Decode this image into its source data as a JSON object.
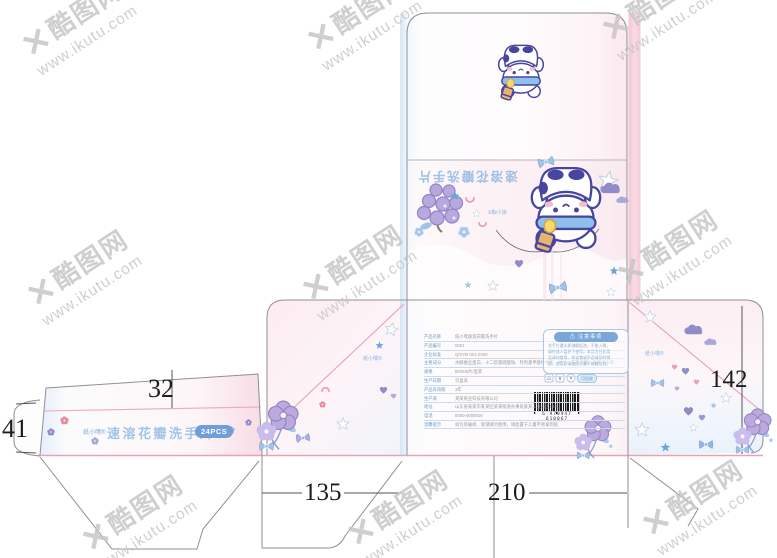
{
  "watermark": {
    "logo": "✕",
    "brand": "酷图网",
    "url": "www.ikutu.com"
  },
  "dimensions": {
    "top": "32",
    "left_tab": "41",
    "bottom_left": "135",
    "bottom_center": "210",
    "right": "142"
  },
  "brand": {
    "name": "纸小嘿®"
  },
  "side_strip": {
    "title": "速溶花瓣洗手片",
    "badge": "24PCS"
  },
  "back_panel": {
    "title": "速溶花瓣洗手片",
    "brand": "纸小嘿®"
  },
  "side_panels": {
    "left_brand": "纸小嘿®",
    "right_brand": "纸小嘿®"
  },
  "front_panel": {
    "table": {
      "rows": [
        {
          "label": "产品名称",
          "value": "纸小嘿速溶花瓣洗手片"
        },
        {
          "label": "产品编号",
          "value": "0001"
        },
        {
          "label": "企业标准",
          "value": "Q/XYB 001-2020"
        },
        {
          "label": "主要成分",
          "value": "水解蚕丝蛋白、十二烷基硫酸钠、羟丙基甲基纤维素、甘油、花瓣香精、去离子水等"
        },
        {
          "label": "规格",
          "value": "80/200片/盒装"
        },
        {
          "label": "生产日期",
          "value": "见盒底"
        },
        {
          "label": "产品有效期",
          "value": "3年"
        },
        {
          "label": "生产商",
          "value": "某某纸业科技有限公司"
        },
        {
          "label": "地址",
          "value": "山东省某某市某某区某某街道办事处某某工业园区18号"
        },
        {
          "label": "电话",
          "value": "0000-0000000"
        },
        {
          "label": "温馨提示",
          "value": "如包装破损、受潮请勿使用，请放置于儿童不易拿到处"
        }
      ]
    },
    "notice": {
      "title": "⚠ 注意事项",
      "lines": [
        "洗手片遇水即溶解起泡，不能入眼，",
        "请在成人监护下使用，本品为日化用",
        "品请勿食用，如误食或不适请及时就",
        "医，使用后请放回儿童不易触及处。"
      ]
    },
    "eco_badge": "可回收",
    "barcode_digits": "6 970947 610067"
  }
}
